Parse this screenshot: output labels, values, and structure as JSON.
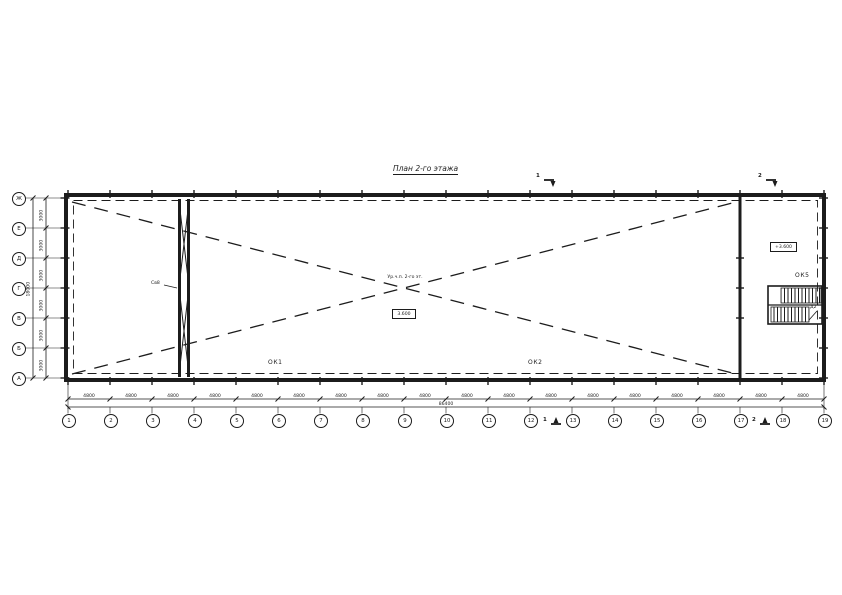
{
  "title": "План 2-го этажа",
  "colors": {
    "ink": "#1c1c1c",
    "background": "#ffffff"
  },
  "axes": {
    "bottom": {
      "labels": [
        "1",
        "2",
        "3",
        "4",
        "5",
        "6",
        "7",
        "8",
        "9",
        "10",
        "11",
        "12",
        "13",
        "14",
        "15",
        "16",
        "17",
        "18",
        "19"
      ]
    },
    "left": {
      "labels": [
        "Ж",
        "Е",
        "Д",
        "Г",
        "В",
        "Б",
        "А"
      ]
    }
  },
  "dimensions": {
    "bottom_bays": [
      "4800",
      "4800",
      "4800",
      "4800",
      "4800",
      "4800",
      "4800",
      "4800",
      "4800",
      "4800",
      "4800",
      "4800",
      "4800",
      "4800",
      "4800",
      "4800",
      "4800",
      "4800"
    ],
    "bottom_total": "86400",
    "left_bays": [
      "3000",
      "3000",
      "3000",
      "3000",
      "3000",
      "3000"
    ],
    "left_total": "18000"
  },
  "labels": {
    "window1": "ОК1",
    "window2": "ОК2",
    "window5": "ОК5",
    "door2": "Д2",
    "brace": "Св8",
    "center_note": "Ур.ч.п. 2-го эт.",
    "center_elevation": "3.600",
    "room_elevation": "+3.600",
    "section1": "1",
    "section2": "2"
  }
}
